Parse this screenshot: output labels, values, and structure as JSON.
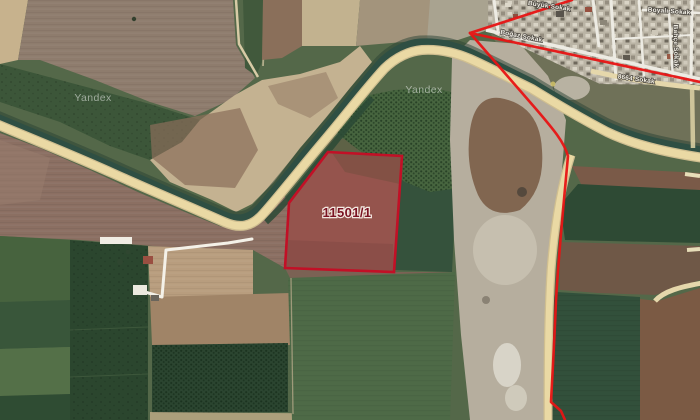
{
  "app": {
    "name": "Yandex Maps",
    "view": "satellite"
  },
  "watermark": {
    "text": "Yandex"
  },
  "parcel": {
    "number": "11501/1",
    "fill": "rgba(193,28,46,0.27)",
    "stroke": "#c21026",
    "label_color": "#7a1322",
    "halo": "#f3e9e1"
  },
  "boundary": {
    "color": "#e81414"
  },
  "palette": {
    "road": "#ead9a4",
    "road_casing": "#cfbe90",
    "canal": "#2f4f43",
    "tree_band": "#2a4233",
    "track": "#f4f1e8",
    "town_road": "#e5d7ab"
  },
  "streets": [
    {
      "name": "Büyük Sokak"
    },
    {
      "name": "Boğaz Sokak"
    },
    {
      "name": "8664 Sokak"
    },
    {
      "name": "Boyalı Sokak"
    },
    {
      "name": "Bahçe Sokak"
    }
  ]
}
